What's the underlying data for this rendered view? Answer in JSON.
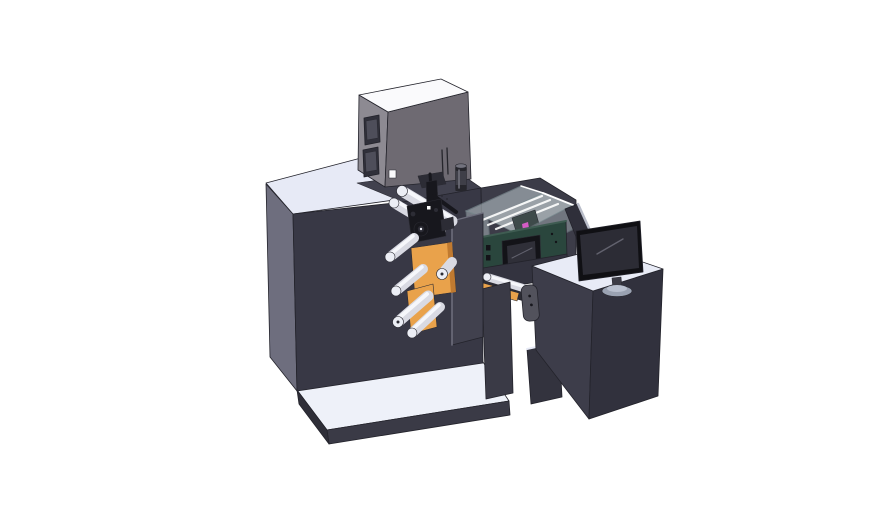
{
  "colors": {
    "background": "#ffffff",
    "outline": "#23232b",
    "top_light": "#e7eaf6",
    "top_light2": "#eef1f9",
    "cabinet_front": "#383845",
    "cabinet_side": "#6e6e7e",
    "cabinet_top_dark": "#41414e",
    "slab_front": "#3a3a46",
    "slab_side": "#2e2e38",
    "box_top": "#fafafc",
    "box_left": "#8d8a92",
    "box_front": "#6e6a72",
    "box_window": "#30303a",
    "box_window_inner": "#4e4e5a",
    "beacon": "#3f3f48",
    "beacon_dark": "#26262c",
    "beacon_hl": "#73737e",
    "mech_dark": "#17171d",
    "mech_mid": "#2c2c35",
    "roller": "#d9dae3",
    "roller_hl": "#f6f7fb",
    "roller_cap": "#eceef5",
    "roller_ring": "#8f8f9e",
    "orange": "#e9a24b",
    "orange_dark": "#c07a30",
    "plate": "#41414e",
    "plate_edge": "#6d6d7c",
    "bay": "#3c3c48",
    "enclosure_wall": "#c2ced2",
    "enclosure_edge": "#8fa2a6",
    "enclosure_floor": "#cdd8da",
    "rail": "#ffffff",
    "pink": "#d45cc5",
    "carriage": "#3e4a4a",
    "green_box": "#2a463d",
    "green_edge": "#3f5c52",
    "screen_bezel": "#131318",
    "screen": "#2f2f38",
    "support": "#33333f",
    "leg": "#3a3a46",
    "handle": "#52525c",
    "desk_front": "#3d3d4a",
    "desk_side": "#31313d",
    "desk_top": "#e8ebf6",
    "pedestal": "#33333e",
    "panel": "#2f2f3a",
    "panel_edge": "#b9bdc9",
    "monitor_bezel": "#101014",
    "monitor_screen": "#2c2c35",
    "monitor_hl": "#62626e",
    "monitor_base": "#9aa2b2",
    "monitor_neck": "#3c3c46",
    "base_hl": "#b9c0cf"
  }
}
